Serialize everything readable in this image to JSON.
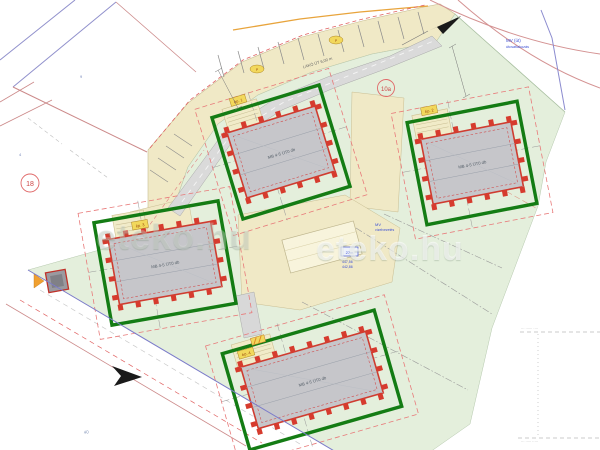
{
  "plan": {
    "watermark": "eteko.hu",
    "watermark_faint": "eteko.hu",
    "road_label": "LAKÓ ÚT 6,00 m",
    "parcels": {
      "p18": "18",
      "p10a": "10a"
    },
    "notes": {
      "n9": "9",
      "n4": "4",
      "n40": "40"
    },
    "blue_notes": {
      "nw1": "MV (út)",
      "nw2": "útcsatlakozás",
      "mid1": "MV",
      "mid2": "vízelvezetés",
      "box": "27m",
      "num1": "447,56",
      "num2": "442,86"
    },
    "gray_notes": {
      "br_top": "··· ······ ····",
      "br_bottom": "··· ····· ·····"
    },
    "road_tags": {
      "t1": "P",
      "t2": "P"
    },
    "buildings": {
      "b1": {
        "label": "MB 4-5 ÜT0 db",
        "tag": "ép. 1"
      },
      "b2": {
        "label": "MB 4-5 ÜT0 db",
        "tag": "ép. 2"
      },
      "b3": {
        "label": "MB 4-5 ÜT0 db",
        "tag": "ép. 3"
      },
      "b4": {
        "label": "MB 4-5 ÜT0 db",
        "tag": "ép. 4"
      }
    },
    "colors": {
      "plot_boundary_green": "#147c14",
      "wall_red": "#d63b2e",
      "cadastral_blue": "#9090cc",
      "cadastral_red": "#cc8a8a",
      "lawn_green": "#e4efdc",
      "pavement_cream": "#f0e9c6"
    }
  }
}
